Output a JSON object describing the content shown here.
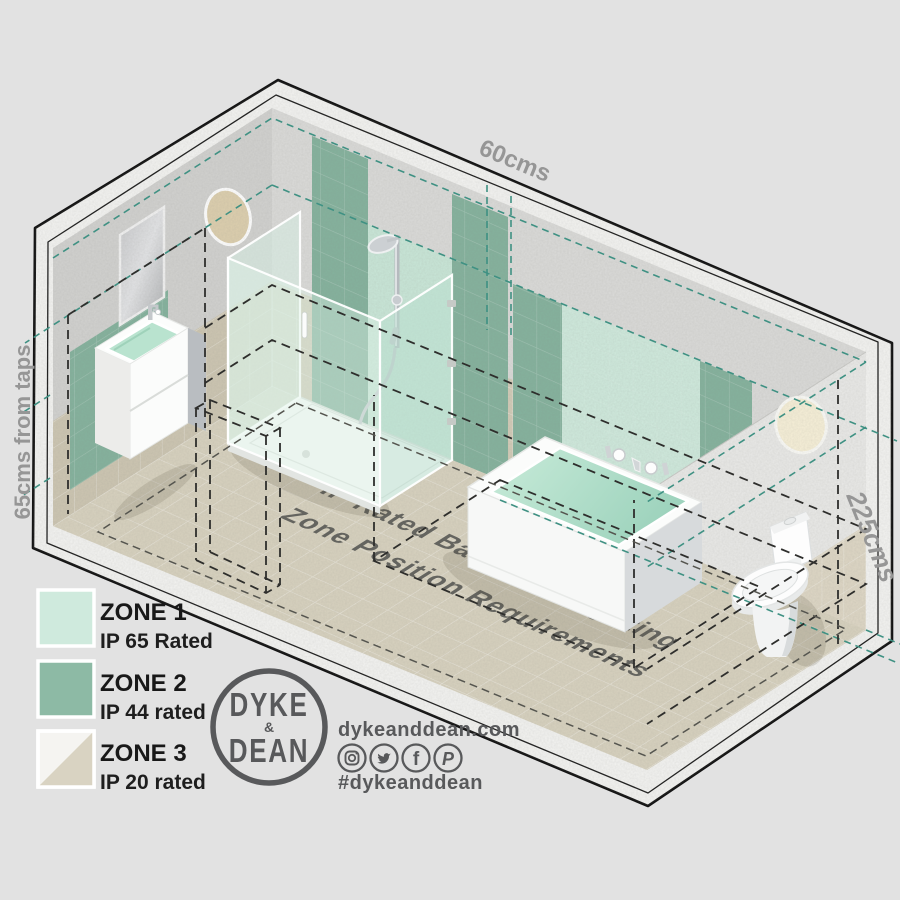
{
  "scene": {
    "dimensions": {
      "top": "60cms",
      "left": "65cms from taps",
      "right": "225cms"
    },
    "floor_title": {
      "line1": "IP Rated Bathroom Lighting",
      "line2": "Zone Position Requirements"
    },
    "fixtures": [
      "mirror",
      "vanity-basin",
      "shower-enclosure",
      "bathtub",
      "toilet",
      "wall-light-left",
      "wall-light-right",
      "door-outline"
    ]
  },
  "legend": {
    "items": [
      {
        "label": "ZONE 1",
        "rating": "IP 65 Rated",
        "color": "#cfeadd"
      },
      {
        "label": "ZONE 2",
        "rating": "IP 44 rated",
        "color": "#8dbaa5"
      },
      {
        "label": "ZONE 3",
        "rating": "IP 20 rated",
        "color_top": "#f5f4f1",
        "color_bottom": "#d9d3c2"
      }
    ]
  },
  "brand": {
    "logo_top": "DYKE",
    "logo_mid": "&",
    "logo_bottom": "DEAN",
    "website": "dykeanddean.com",
    "hashtag": "#dykeanddean",
    "social": [
      {
        "name": "instagram"
      },
      {
        "name": "twitter"
      },
      {
        "name": "facebook"
      },
      {
        "name": "pinterest"
      }
    ]
  },
  "colors": {
    "background": "#e2e2e2",
    "zone1_mint": "#cfeadd",
    "zone2_green": "#8dbaa5",
    "zone3_beige": "#d9d3c2",
    "teal_dash": "#3f9183",
    "black_dash": "#2e2e2c",
    "brand_gray": "#58595b",
    "floor": "#d8d2bf",
    "wall_concrete": "#dbdbd9"
  }
}
